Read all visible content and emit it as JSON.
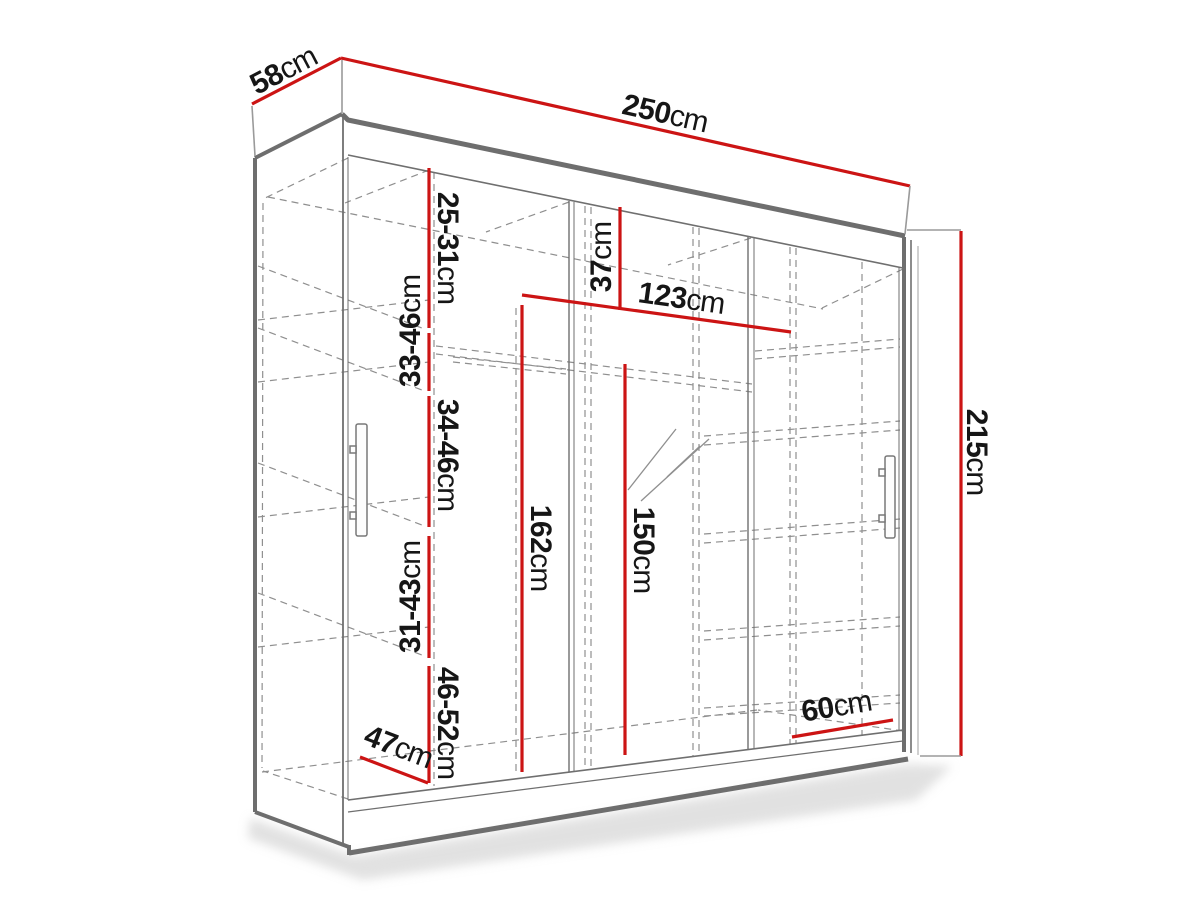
{
  "diagram": {
    "title": "wardrobe-dimension-diagram",
    "colors": {
      "dimension_line": "#cc1414",
      "outline": "#6e6e6e",
      "hidden_line": "#8f8f8f",
      "label_text": "#161616",
      "background": "#ffffff"
    },
    "dimensions": {
      "depth": {
        "value": "58",
        "unit": "cm"
      },
      "width": {
        "value": "250",
        "unit": "cm"
      },
      "height": {
        "value": "215",
        "unit": "cm"
      },
      "gap1": {
        "value": "25-31",
        "unit": "cm"
      },
      "gap2": {
        "value": "33-46",
        "unit": "cm"
      },
      "gap3": {
        "value": "34-46",
        "unit": "cm"
      },
      "gap4": {
        "value": "31-43",
        "unit": "cm"
      },
      "gap5": {
        "value": "46-52",
        "unit": "cm"
      },
      "top_section": {
        "value": "37",
        "unit": "cm"
      },
      "inner_width": {
        "value": "123",
        "unit": "cm"
      },
      "hang_left": {
        "value": "162",
        "unit": "cm"
      },
      "hang_right": {
        "value": "150",
        "unit": "cm"
      },
      "floor_left": {
        "value": "47",
        "unit": "cm"
      },
      "floor_right": {
        "value": "60",
        "unit": "cm"
      }
    }
  }
}
